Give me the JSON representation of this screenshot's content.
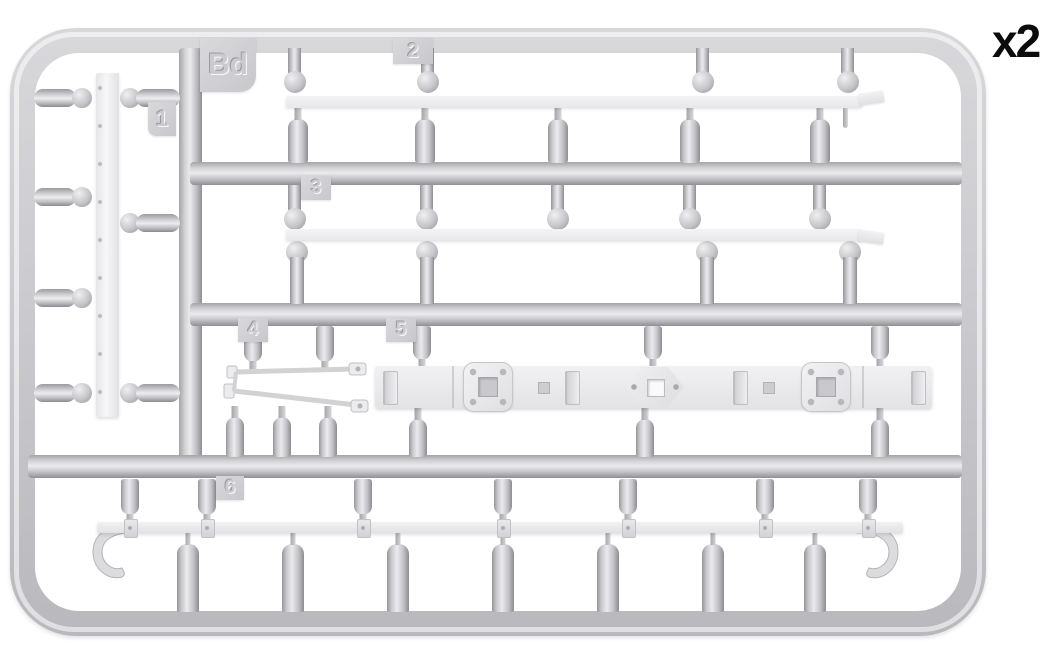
{
  "diagram": {
    "type": "model-kit-sprue-parts-diagram",
    "quantity_label": "x2",
    "sprue": {
      "code": "Bd",
      "parts": [
        {
          "number": "1",
          "shape": "flat-rail-strip"
        },
        {
          "number": "2",
          "shape": "leaf-spring"
        },
        {
          "number": "3",
          "shape": "leaf-spring"
        },
        {
          "number": "4",
          "shape": "tow-bracket-frame"
        },
        {
          "number": "5",
          "shape": "chassis-beam-with-mounting-plates"
        },
        {
          "number": "6",
          "shape": "tow-bar-with-end-hooks"
        }
      ]
    },
    "colors": {
      "plastic_gray": "#cdcdd1",
      "plastic_light": "#ededef",
      "part_white": "#f2f2f4",
      "background": "#ffffff",
      "label_text": "#0c0c0c"
    }
  }
}
